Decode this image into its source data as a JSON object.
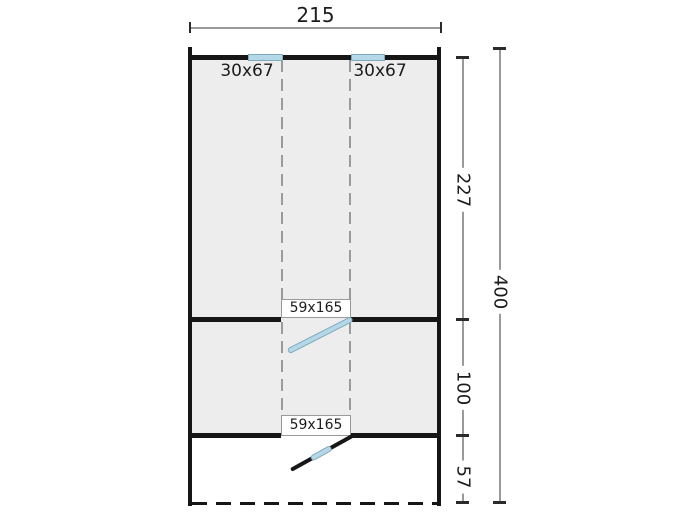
{
  "drawing": {
    "type": "floor-plan",
    "top_dimension": {
      "value": "215"
    },
    "right_dimensions": {
      "segments": [
        {
          "value": "227"
        },
        {
          "value": "100"
        },
        {
          "value": "57"
        }
      ],
      "total": {
        "value": "400"
      }
    },
    "windows": [
      {
        "label": "30x67"
      },
      {
        "label": "30x67"
      }
    ],
    "doors": [
      {
        "label": "59x165"
      },
      {
        "label": "59x165"
      }
    ],
    "colors": {
      "wall": "#161616",
      "room_fill": "#ededed",
      "glazing_blue": "#b4d8e8",
      "glazing_border": "#7fa9bd",
      "dimension_line": "#9a9a9a",
      "tick": "#2b2b2b",
      "text": "#1c1c1c",
      "background": "#ffffff"
    }
  }
}
